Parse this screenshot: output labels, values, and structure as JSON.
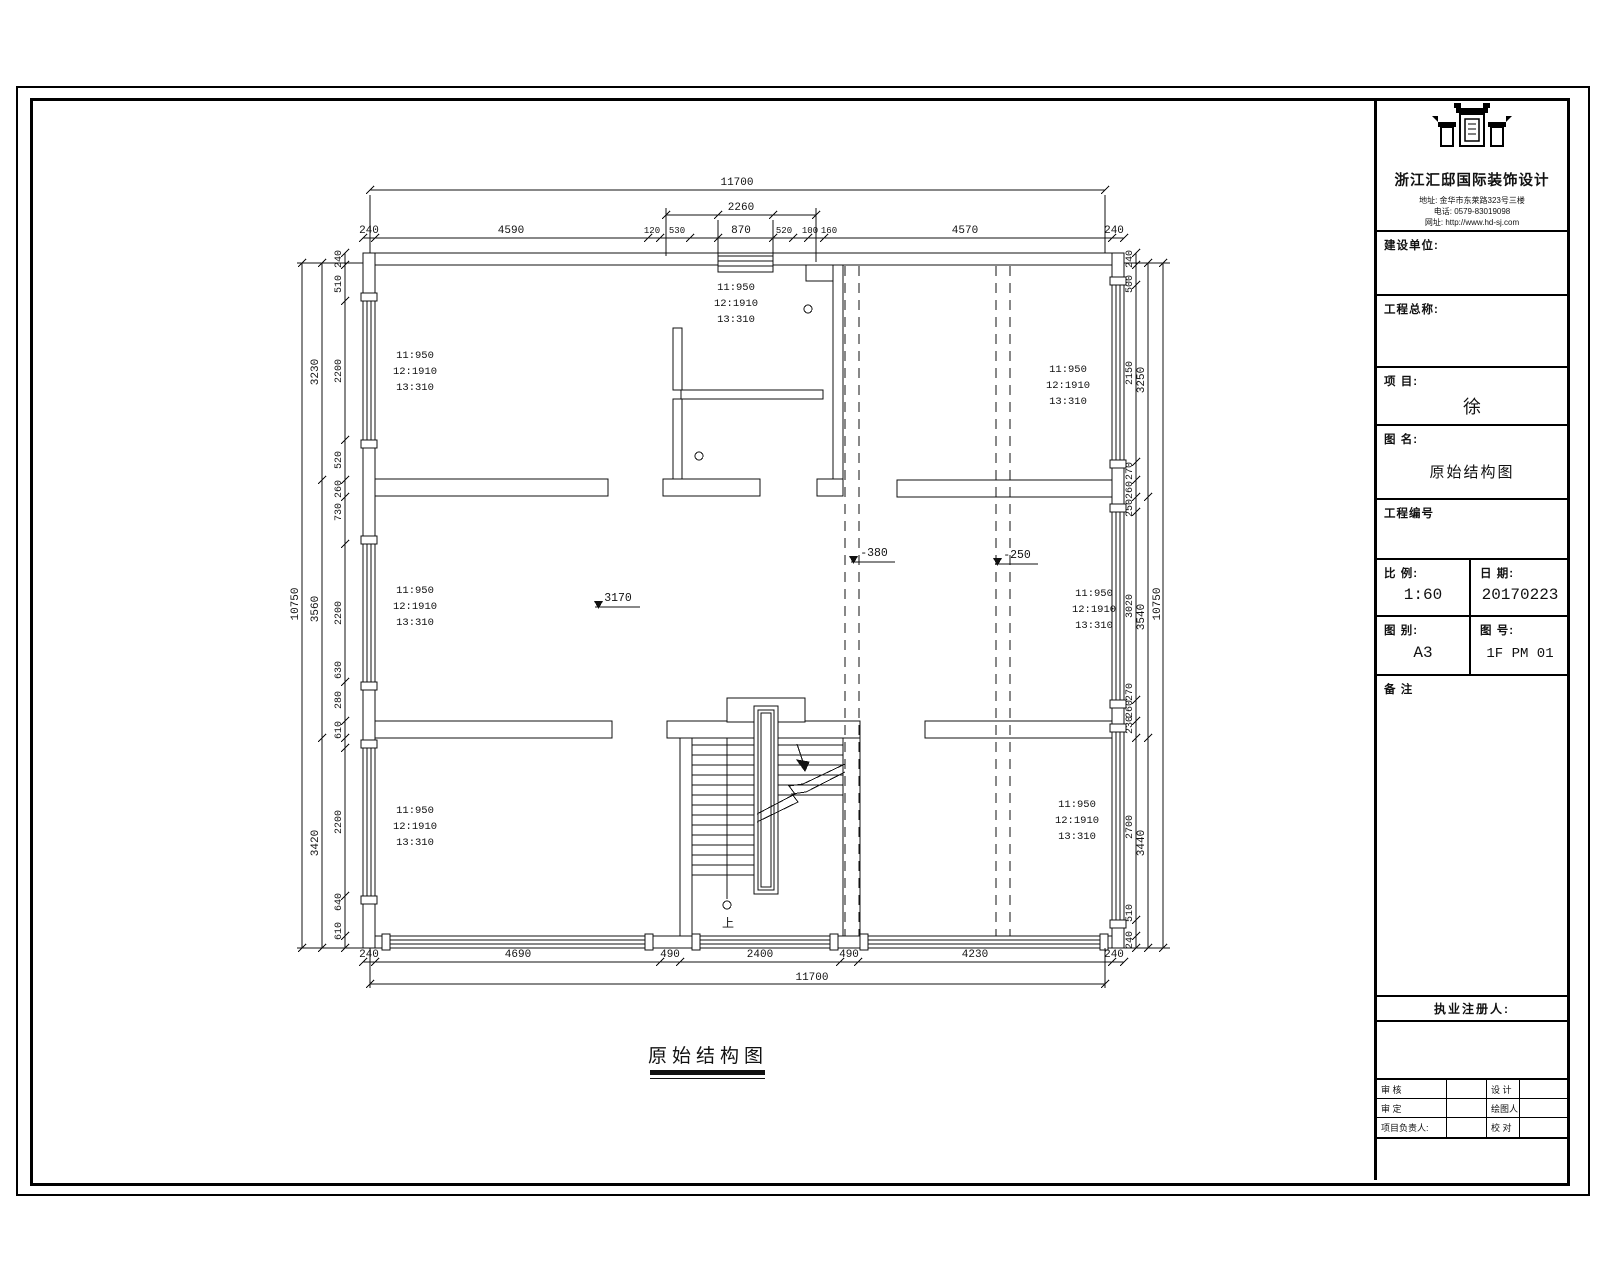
{
  "plan": {
    "caption": "原始结构图",
    "note": {
      "l1": "11:950",
      "l2": "12:1910",
      "l3": "13:310"
    },
    "levels": {
      "main": "3170",
      "a": "-380",
      "b": "-250"
    },
    "stair_down": "上"
  },
  "dims": {
    "top": {
      "overall": "11700",
      "sub": "2260",
      "segments": [
        "240",
        "4590",
        "120",
        "530",
        "870",
        "520",
        "100",
        "160",
        "4570",
        "240"
      ]
    },
    "bottom": {
      "overall": "11700",
      "segments": [
        "240",
        "4690",
        "490",
        "2400",
        "490",
        "4230",
        "240"
      ]
    },
    "left": {
      "overall": "10750",
      "mid": [
        "3230",
        "3560",
        "3420"
      ],
      "inner": [
        "240",
        "510",
        "2200",
        "520",
        "260",
        "730",
        "2200",
        "630",
        "280",
        "610",
        "2200",
        "640",
        "610"
      ]
    },
    "right": {
      "overall": "10750",
      "mid": [
        "3250",
        "3540",
        "3440"
      ],
      "inner": [
        "240",
        "500",
        "2150",
        "270",
        "260",
        "250",
        "3020",
        "270",
        "260",
        "230",
        "2700",
        "510",
        "240"
      ]
    }
  },
  "titleblock": {
    "company": "浙江汇邸国际装饰设计",
    "address": "地址: 金华市东莱路323号三楼",
    "phone": "电话: 0579-83019098",
    "website": "网址: http://www.hd-sj.com",
    "owner_label": "建设单位:",
    "project_title_label": "工程总称:",
    "project_label": "项 目:",
    "project_value": "徐",
    "drawing_name_label": "图 名:",
    "drawing_name_value": "原始结构图",
    "project_no_label": "工程编号",
    "scale_label": "比 例:",
    "scale_value": "1:60",
    "date_label": "日 期:",
    "date_value": "20170223",
    "sheet_type_label": "图 别:",
    "sheet_type_value": "A3",
    "sheet_no_label": "图 号:",
    "sheet_no_value": "1F PM 01",
    "remarks_label": "备 注",
    "registrant_label": "执业注册人:",
    "review_label": "审 核",
    "design_label": "设 计",
    "approve_label": "审 定",
    "draftsman_label": "绘图人",
    "pm_label": "项目负责人:",
    "proofread_label": "校 对"
  }
}
